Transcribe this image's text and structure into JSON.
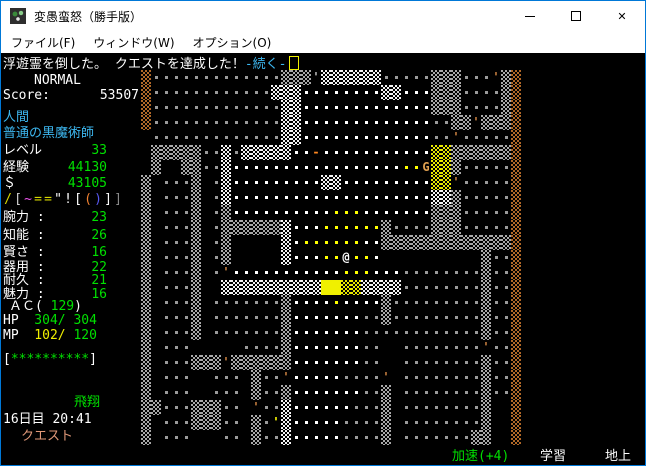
{
  "window": {
    "title": "変愚蛮怒（勝手版）",
    "controls": {
      "minimize": "minimize",
      "maximize": "maximize",
      "close": "✕"
    }
  },
  "menu": {
    "items": [
      {
        "label": "ファイル(F)"
      },
      {
        "label": "ウィンドウ(W)"
      },
      {
        "label": "オプション(O)"
      }
    ]
  },
  "message": {
    "text": "浮遊霊を倒した。 クエストを達成した！",
    "more_prompt": "-続く-"
  },
  "sidebar": {
    "mode": "NORMAL",
    "score_label": "Score:",
    "score_value": "53507",
    "race": "人間",
    "class_title": "普通の黒魔術師",
    "level": {
      "label": "レベル",
      "value": "33"
    },
    "exp": {
      "label": "経験",
      "value": "44130"
    },
    "gold": {
      "label": "＄",
      "value": "43105"
    },
    "equipment": [
      {
        "text": "/",
        "color": "#d8d800"
      },
      {
        "text": "[",
        "color": "#d0d0d0"
      },
      {
        "text": "~",
        "color": "#f055f0"
      },
      {
        "text": "=",
        "color": "#d8d800"
      },
      {
        "text": "=",
        "color": "#d8d800"
      },
      {
        "text": "\"",
        "color": "#ffffff"
      },
      {
        "text": "!",
        "color": "#ffffff"
      },
      {
        "text": "[",
        "color": "#ffffff"
      },
      {
        "text": "(",
        "color": "#f08030"
      },
      {
        "text": ")",
        "color": "#5858f0"
      },
      {
        "text": "]",
        "color": "#ffffff"
      },
      {
        "text": "]",
        "color": "#8a8a8a"
      }
    ],
    "abilities": [
      {
        "label": "腕力 :",
        "value": "23"
      },
      {
        "label": "知能 :",
        "value": "26"
      },
      {
        "label": "賢さ :",
        "value": "16"
      },
      {
        "label": "器用 :",
        "value": "22"
      },
      {
        "label": "耐久 :",
        "value": "21"
      },
      {
        "label": "魅力 :",
        "value": "16"
      }
    ],
    "ac": {
      "prefix": "ＡＣ(",
      "value": " 129",
      "suffix": ")"
    },
    "hp": {
      "label": "HP",
      "cur": "  304/",
      "max": " 304"
    },
    "mp": {
      "label": "MP",
      "cur": "  102/",
      "max": " 120"
    },
    "bar": {
      "open": "[",
      "stars": "**********",
      "close": "]"
    },
    "flight": "飛翔",
    "date_time": "16日目 20:41",
    "quest": "クエスト"
  },
  "statusbar": {
    "speed": "加速(+4)",
    "learning": "学習",
    "location": "地上"
  },
  "colors": {
    "stat_green": "#00e000",
    "warn_yellow": "#f0f000",
    "info_cyan": "#3db7f0",
    "quest_tan": "#e09878",
    "text_white": "#ffffff"
  },
  "map": {
    "legend": {
      "g": {
        "kind": "dot",
        "color": "#9a9a9a",
        "name": "floor-dark"
      },
      "w": {
        "kind": "dot",
        "color": "#ffffff",
        "name": "floor-lit"
      },
      "y": {
        "kind": "dot",
        "color": "#ffff00",
        "name": "floor-glow"
      },
      "#": {
        "kind": "wall",
        "color": "#a8a8a8",
        "name": "granite-wall"
      },
      "W": {
        "kind": "wall",
        "color": "#f4f4f4",
        "name": "quartz-vein-wall"
      },
      "Y": {
        "kind": "wall",
        "color": "#e8e800",
        "name": "gold-vein-wall"
      },
      "Z": {
        "kind": "wall-solid",
        "color": "#f0f000",
        "name": "gold-vein-block"
      },
      "B": {
        "kind": "wall",
        "color": "#b06828",
        "name": "rubble-wall"
      },
      "'": {
        "kind": "glyph",
        "char": "'",
        "color": "#b8b8b8",
        "name": "open-door"
      },
      "d": {
        "kind": "glyph",
        "char": "'",
        "color": "#c88040",
        "name": "open-door-wood"
      },
      ",": {
        "kind": "glyph",
        "char": "'",
        "color": "#ffff00",
        "name": "item-yellow"
      },
      "-": {
        "kind": "glyph",
        "char": "-",
        "color": "#ff8820",
        "name": "item-wand"
      },
      "G": {
        "kind": "glyph",
        "char": "G",
        "color": "#e0a050",
        "name": "ghost-monster"
      },
      "@": {
        "kind": "glyph",
        "char": "@",
        "color": "#ffffff",
        "name": "player"
      }
    },
    "rows": [
      "Bggggggggggggg###'WWWWWWggggg###gggd#B............",
      "BggggggggggggWWWwwwwwwwwWWwww###gggg#B............",
      "BgggggggggggggWWwwwwwwwwwwwww###gggg#B............",
      "BgggggggggggggWWwwwwwwwwwwwwwgg##d###B............",
      ".gggggggggggggWWwwwwwwwwwwwwwggdgggggB............",
      ".#####ggWgWWWWWww-wwwwwwwwwwwYY######B............",
      ".#..##ggWwwwwwwwwwwwwwwwwwyyGYY#gggggB............",
      "#.ggg#.gWwwwwwwwwwWWwwwwwwwwwYYdgggggB............",
      "#.ggg#.gWwwwwwwwwwwwwwwwwwwwwWW#gggggB............",
      "#.ggg#.g#wwwwwwwwwwyyywwwwwww###gggggB............",
      "#.ggg#.g######Wwwwyyyyyy#gggg###gggggB............",
      "#.ggg#.g#.....Wwyyyyyyww#############B............",
      "#.ggg#.g#.....Wwwwyy@yyw..........#ggB............",
      "#.ggg#.gdwwwwwwwwwwwyyywwwgggggggg#ggB............",
      "#.ggg#..WWWWWWWWWWZZYYWWWWgggggggg#ggB............",
      "#.ggg#.ggggggg#wwwwywwww#ggggggggg#ggB............",
      "#.ggg#.ggggggg#wwwwwwwgg#ggggggggg#ggB............",
      "#.ggg#.ggggggg#wwwwwwwgggggggggggg#ggB............",
      "#.ggg.....gggg#wwwwwwwgg..ggggggggdggB............",
      "#.ggg###d######wwwwwwwgg..gggggggg#ggB............",
      "#.ggg..ggg.#ggdwwwwwggggd.gggggggg#ggB............",
      "#.ggg..ggg.#gg#wwwwwwwgg#.gggggggg#ggB............",
      "##ggg###gg.dggWwwwwwwggg#.gggggggg#..B............",
      "#.ggg###gg.#g,Wwwwwwgggg#.gggggggg#..B............",
      "#.ggg...gg.#ggWwwwwwgggg#.ggggggg##..B............"
    ]
  }
}
